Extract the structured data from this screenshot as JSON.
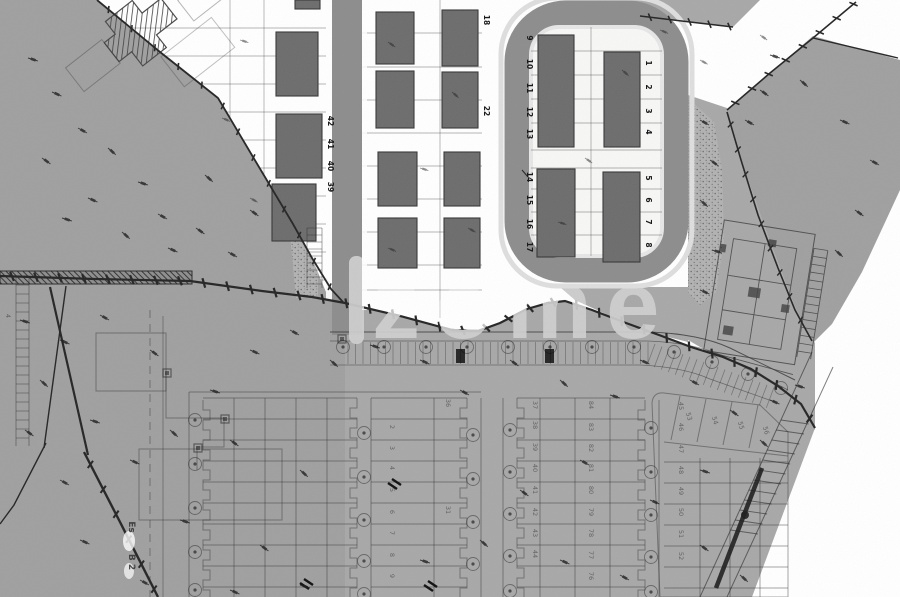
{
  "watermark": {
    "text": "zome"
  },
  "plan_labels": {
    "left_strip_lots": [
      "42",
      "41",
      "40",
      "39"
    ],
    "mid_strip_lots": [
      "18",
      "22"
    ],
    "loop_left_upper": [
      "9",
      "10",
      "11",
      "12",
      "13"
    ],
    "loop_left_lower": [
      "14",
      "15",
      "16",
      "17"
    ],
    "loop_right_upper": [
      "1",
      "2",
      "3",
      "4"
    ],
    "loop_right_lower": [
      "5",
      "6",
      "7",
      "8"
    ],
    "bottom_col_a": [
      "2",
      "3",
      "4",
      "5",
      "6",
      "7",
      "8",
      "9"
    ],
    "bottom_col_b": [
      "36",
      "31"
    ],
    "bottom_col_c": [
      "37",
      "38",
      "39",
      "40",
      "41",
      "42",
      "43",
      "44"
    ],
    "bottom_col_d": [
      "84",
      "83",
      "82",
      "81",
      "80",
      "79",
      "78",
      "77",
      "76"
    ],
    "bottom_col_e": [
      "45",
      "46",
      "47",
      "48",
      "49",
      "50",
      "51",
      "52"
    ],
    "fan_lots": [
      "53",
      "54",
      "55",
      "56"
    ],
    "side_label_top": "Es",
    "side_label_bottom": "B 2",
    "edge_label": "4"
  },
  "colors": {
    "paper": "#ffffff",
    "field": "#a8a8a8",
    "hill": "#a0a0a0",
    "road": "#8d8d8d",
    "sidewalk": "#dedede",
    "island": "#f7f7f6",
    "building": "#6d6d6d",
    "building_edge": "#383838",
    "line_dark": "#262626",
    "label": "#161616",
    "watermark": "#cfcfcf"
  }
}
